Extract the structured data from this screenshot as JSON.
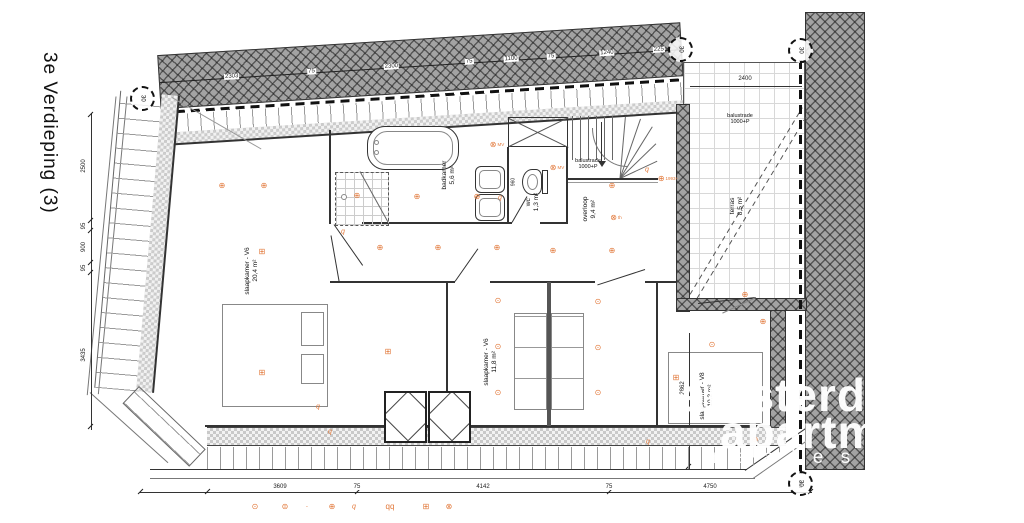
{
  "title": "3e Verdieping (3)",
  "rooms": {
    "left": {
      "name": "slaapkamer - V6",
      "area": "20,4 m²"
    },
    "mid": {
      "name": "slaapkamer - V6",
      "area": "11,8 m²"
    },
    "right": {
      "name": "slaapkamer - V8",
      "area": "10,2 m²"
    },
    "badkamer": {
      "name": "badkamer",
      "area": "5,6 m²"
    },
    "wc": {
      "name": "wc",
      "area": "1,3 m²"
    },
    "overloop": {
      "name": "overloop",
      "area": "9,4 m²"
    },
    "terras": {
      "name": "terras",
      "area": "8,5 m²"
    }
  },
  "annotations": {
    "balustrade_stairs": "balustrade\n1000+P",
    "balustrade_terras": "balustrade\n1000+P",
    "wc_height": "960"
  },
  "dims": {
    "top": [
      "2303",
      "75",
      "2300",
      "75",
      "1100",
      "75",
      "1240",
      "225"
    ],
    "left": [
      "2500",
      "95",
      "900",
      "95",
      "3435"
    ],
    "bottom": [
      "3609",
      "75",
      "4142",
      "75",
      "4750"
    ],
    "terras": "2400",
    "bedroom_right": "2862"
  },
  "section_marker": "30",
  "watermark": {
    "line1": "amsterdam",
    "line2": "apartments",
    "line3": "r e a l   e s t a t e"
  },
  "glyphs": {
    "socket": "⊕",
    "ceil": "⊞",
    "spot": "⊗",
    "dot": "⊙",
    "sw": "q",
    "pend": "⊙",
    "pend2": "⊜",
    "ldot": "·",
    "sw2": "qq"
  },
  "plan_symbols": [
    {
      "x": 222,
      "y": 186,
      "t": "socket"
    },
    {
      "x": 264,
      "y": 186,
      "t": "socket"
    },
    {
      "x": 262,
      "y": 252,
      "t": "ceil"
    },
    {
      "x": 262,
      "y": 373,
      "t": "ceil"
    },
    {
      "x": 388,
      "y": 352,
      "t": "ceil"
    },
    {
      "x": 343,
      "y": 232,
      "t": "sw"
    },
    {
      "x": 357,
      "y": 196,
      "t": "socket"
    },
    {
      "x": 417,
      "y": 197,
      "t": "socket"
    },
    {
      "x": 477,
      "y": 197,
      "t": "socket"
    },
    {
      "x": 500,
      "y": 198,
      "t": "sw"
    },
    {
      "x": 497,
      "y": 145,
      "t": "spot",
      "label": "MV"
    },
    {
      "x": 557,
      "y": 168,
      "t": "spot",
      "label": "MV"
    },
    {
      "x": 612,
      "y": 186,
      "t": "socket"
    },
    {
      "x": 616,
      "y": 218,
      "t": "spot",
      "label": "th"
    },
    {
      "x": 553,
      "y": 251,
      "t": "socket"
    },
    {
      "x": 612,
      "y": 251,
      "t": "socket"
    },
    {
      "x": 647,
      "y": 170,
      "t": "sw"
    },
    {
      "x": 380,
      "y": 248,
      "t": "socket"
    },
    {
      "x": 438,
      "y": 248,
      "t": "socket"
    },
    {
      "x": 497,
      "y": 248,
      "t": "socket"
    },
    {
      "x": 498,
      "y": 301,
      "t": "dot"
    },
    {
      "x": 498,
      "y": 347,
      "t": "dot"
    },
    {
      "x": 498,
      "y": 393,
      "t": "dot"
    },
    {
      "x": 598,
      "y": 302,
      "t": "dot"
    },
    {
      "x": 598,
      "y": 348,
      "t": "dot"
    },
    {
      "x": 598,
      "y": 393,
      "t": "dot"
    },
    {
      "x": 676,
      "y": 378,
      "t": "ceil"
    },
    {
      "x": 712,
      "y": 345,
      "t": "dot"
    },
    {
      "x": 318,
      "y": 407,
      "t": "sw"
    },
    {
      "x": 330,
      "y": 432,
      "t": "sw"
    },
    {
      "x": 648,
      "y": 442,
      "t": "sw"
    },
    {
      "x": 755,
      "y": 440,
      "t": "socket"
    },
    {
      "x": 745,
      "y": 295,
      "t": "socket"
    },
    {
      "x": 763,
      "y": 322,
      "t": "socket"
    },
    {
      "x": 668,
      "y": 179,
      "t": "socket",
      "label": "1993+"
    }
  ],
  "legend": [
    {
      "x": 255,
      "t": "pend"
    },
    {
      "x": 285,
      "t": "pend2"
    },
    {
      "x": 307,
      "t": "ldot"
    },
    {
      "x": 332,
      "t": "socket"
    },
    {
      "x": 354,
      "t": "sw"
    },
    {
      "x": 390,
      "t": "sw2"
    },
    {
      "x": 426,
      "t": "ceil"
    },
    {
      "x": 449,
      "t": "spot"
    }
  ],
  "legend_y": 507
}
